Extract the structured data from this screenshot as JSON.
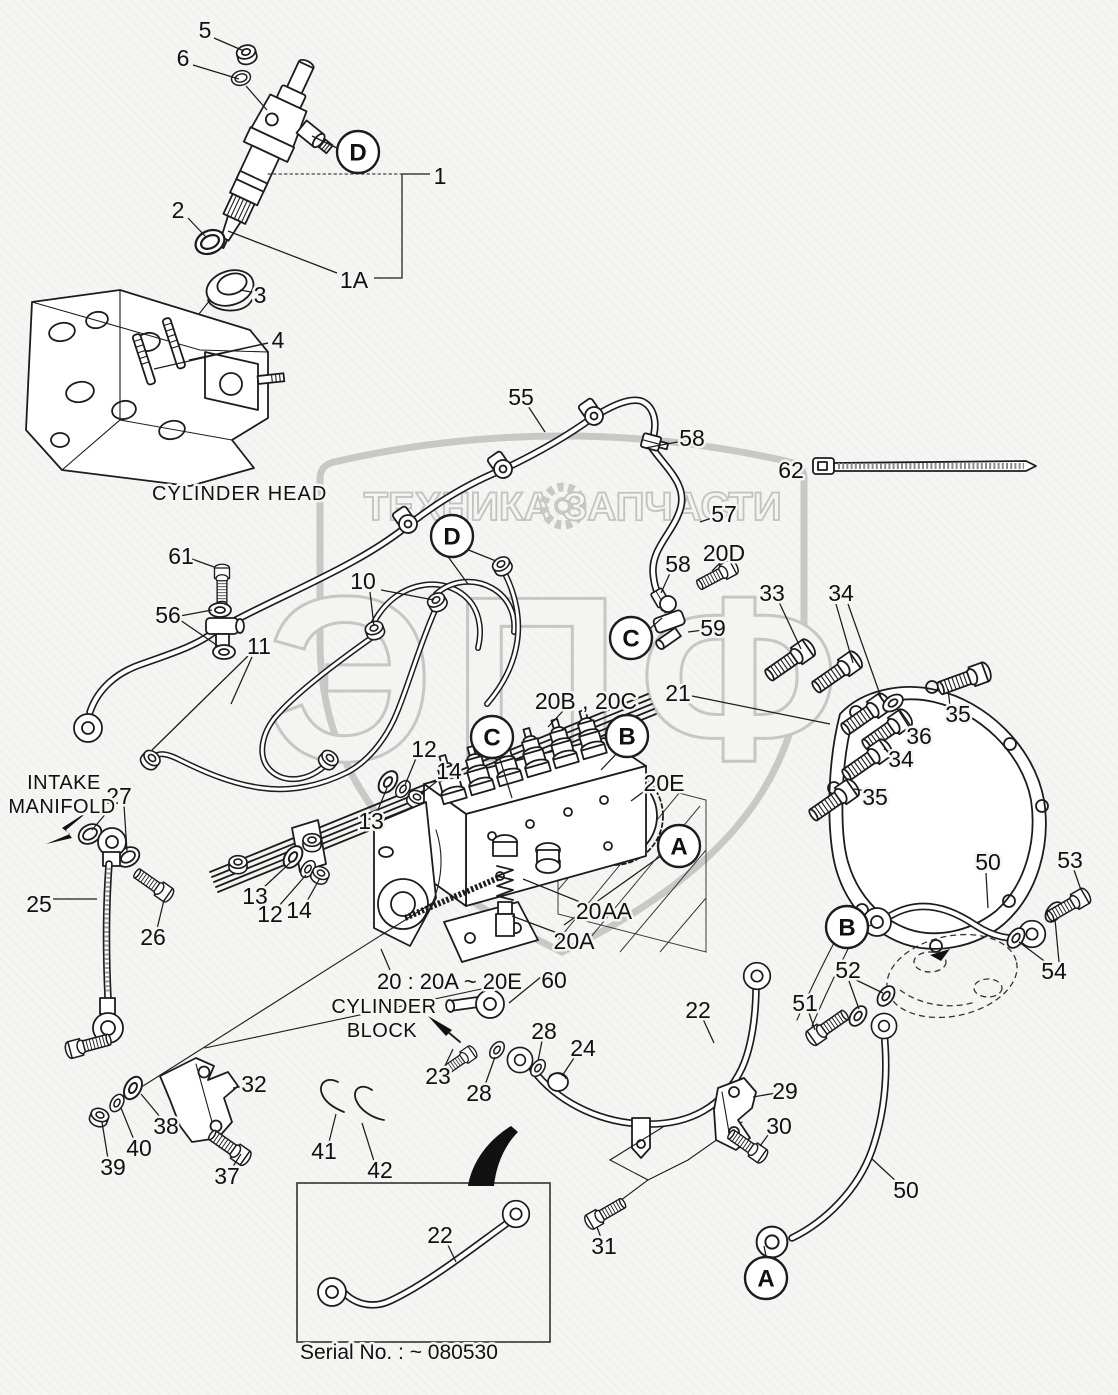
{
  "figure": {
    "colors": {
      "ink": "#1c1c1c",
      "background": "#f5f5f3",
      "watermark": "#c8c8c6"
    },
    "watermark": {
      "band_left": "ТЕХНИКА",
      "band_right": "ЗАПЧАСТИ",
      "monogram": "ЭПФ",
      "gear_icon": "gear-icon"
    },
    "texts": [
      {
        "id": "cylinder-head-label",
        "text": "CYLINDER HEAD",
        "x": 152,
        "y": 500,
        "size": 20,
        "anchor": "start",
        "spacing": 1
      },
      {
        "id": "intake-manifold-line1",
        "text": "INTAKE",
        "x": 64,
        "y": 789,
        "size": 20,
        "anchor": "middle",
        "spacing": 0.5
      },
      {
        "id": "intake-manifold-line2",
        "text": "MANIFOLD",
        "x": 62,
        "y": 813,
        "size": 20,
        "anchor": "middle",
        "spacing": 0.5
      },
      {
        "id": "cylinder-block-line1",
        "text": "CYLINDER",
        "x": 384,
        "y": 1013,
        "size": 20,
        "anchor": "middle",
        "spacing": 0.5
      },
      {
        "id": "cylinder-block-line2",
        "text": "BLOCK",
        "x": 382,
        "y": 1037,
        "size": 20,
        "anchor": "middle",
        "spacing": 0.5
      },
      {
        "id": "pump-group-note",
        "text": "20 : 20A ~ 20E",
        "x": 377,
        "y": 989,
        "size": 22,
        "anchor": "start",
        "spacing": 0
      },
      {
        "id": "serial-note",
        "text": "Serial No. : ~ 080530",
        "x": 300,
        "y": 1359,
        "size": 21,
        "anchor": "start",
        "spacing": 0
      }
    ],
    "callouts": [
      {
        "label": "5",
        "x": 205,
        "y": 30,
        "leaders": [
          [
            214,
            38,
            244,
            51
          ]
        ]
      },
      {
        "label": "6",
        "x": 183,
        "y": 58,
        "leaders": [
          [
            193,
            65,
            239,
            79
          ],
          [
            246,
            86,
            267,
            110
          ]
        ]
      },
      {
        "label": "1",
        "x": 440,
        "y": 176,
        "leaders": []
      },
      {
        "label": "1A",
        "x": 354,
        "y": 280,
        "leaders": [
          [
            337,
            273,
            228,
            231
          ]
        ]
      },
      {
        "label": "2",
        "x": 178,
        "y": 210,
        "leaders": [
          [
            188,
            218,
            206,
            237
          ]
        ]
      },
      {
        "label": "3",
        "x": 260,
        "y": 295,
        "leaders": [
          [
            251,
            292,
            240,
            290
          ]
        ]
      },
      {
        "label": "4",
        "x": 278,
        "y": 340,
        "leaders": [
          [
            268,
            343,
            154,
            369
          ],
          [
            268,
            343,
            189,
            360
          ]
        ]
      },
      {
        "label": "55",
        "x": 521,
        "y": 397,
        "leaders": [
          [
            528,
            406,
            545,
            432
          ]
        ]
      },
      {
        "label": "58",
        "x": 692,
        "y": 438,
        "leaders": [
          [
            683,
            441,
            645,
            448
          ]
        ]
      },
      {
        "label": "62",
        "x": 791,
        "y": 470,
        "leaders": []
      },
      {
        "label": "57",
        "x": 724,
        "y": 514,
        "leaders": [
          [
            715,
            517,
            700,
            522
          ]
        ]
      },
      {
        "label": "20D",
        "x": 724,
        "y": 553,
        "leaders": [
          [
            722,
            561,
            712,
            571
          ]
        ]
      },
      {
        "label": "58",
        "x": 678,
        "y": 564,
        "leaders": [
          [
            671,
            571,
            661,
            593
          ]
        ]
      },
      {
        "label": "59",
        "x": 713,
        "y": 628,
        "leaders": [
          [
            704,
            630,
            688,
            632
          ]
        ]
      },
      {
        "label": "61",
        "x": 181,
        "y": 556,
        "leaders": [
          [
            192,
            559,
            214,
            567
          ]
        ]
      },
      {
        "label": "56",
        "x": 168,
        "y": 615,
        "leaders": [
          [
            180,
            616,
            212,
            610
          ],
          [
            180,
            620,
            218,
            646
          ]
        ]
      },
      {
        "label": "10",
        "x": 363,
        "y": 581,
        "leaders": [
          [
            370,
            592,
            374,
            626
          ],
          [
            381,
            590,
            434,
            600
          ]
        ]
      },
      {
        "label": "11",
        "x": 259,
        "y": 646,
        "leaders": [
          [
            252,
            657,
            231,
            704
          ],
          [
            249,
            655,
            152,
            750
          ]
        ]
      },
      {
        "label": "12",
        "x": 424,
        "y": 749,
        "leaders": [
          [
            417,
            756,
            405,
            785
          ]
        ]
      },
      {
        "label": "14",
        "x": 449,
        "y": 771,
        "leaders": [
          [
            441,
            778,
            421,
            794
          ]
        ]
      },
      {
        "label": "13",
        "x": 371,
        "y": 821,
        "leaders": [
          [
            377,
            812,
            387,
            788
          ]
        ]
      },
      {
        "label": "20B , 20C",
        "x": 586,
        "y": 701,
        "leaders": [
          [
            563,
            711,
            548,
            727
          ]
        ]
      },
      {
        "label": "20E",
        "x": 664,
        "y": 783,
        "leaders": [
          [
            650,
            787,
            631,
            801
          ]
        ]
      },
      {
        "label": "21",
        "x": 678,
        "y": 693,
        "leaders": [
          [
            692,
            696,
            830,
            724
          ]
        ]
      },
      {
        "label": "33",
        "x": 772,
        "y": 593,
        "leaders": [
          [
            779,
            602,
            801,
            649
          ]
        ]
      },
      {
        "label": "34",
        "x": 841,
        "y": 593,
        "leaders": [
          [
            836,
            604,
            853,
            663
          ],
          [
            848,
            604,
            882,
            700
          ]
        ]
      },
      {
        "label": "35",
        "x": 958,
        "y": 714,
        "leaders": [
          [
            950,
            706,
            948,
            689
          ]
        ]
      },
      {
        "label": "36",
        "x": 919,
        "y": 736,
        "leaders": [
          [
            911,
            730,
            897,
            708
          ]
        ]
      },
      {
        "label": "34",
        "x": 901,
        "y": 759,
        "leaders": [
          [
            893,
            753,
            884,
            749
          ]
        ]
      },
      {
        "label": "35",
        "x": 875,
        "y": 797,
        "leaders": [
          [
            867,
            791,
            854,
            789
          ]
        ]
      },
      {
        "label": "27",
        "x": 119,
        "y": 796,
        "leaders": [
          [
            113,
            805,
            92,
            830
          ],
          [
            124,
            805,
            127,
            851
          ]
        ]
      },
      {
        "label": "25",
        "x": 39,
        "y": 904,
        "leaders": [
          [
            53,
            899,
            97,
            899
          ]
        ]
      },
      {
        "label": "26",
        "x": 153,
        "y": 937,
        "leaders": [
          [
            157,
            929,
            164,
            900
          ]
        ]
      },
      {
        "label": "13",
        "x": 255,
        "y": 896,
        "leaders": [
          [
            263,
            888,
            291,
            862
          ]
        ]
      },
      {
        "label": "12",
        "x": 270,
        "y": 914,
        "leaders": [
          [
            278,
            907,
            306,
            875
          ]
        ]
      },
      {
        "label": "14",
        "x": 299,
        "y": 910,
        "leaders": [
          [
            306,
            903,
            320,
            878
          ]
        ]
      },
      {
        "label": "20AA",
        "x": 604,
        "y": 911,
        "leaders": [
          [
            585,
            904,
            523,
            879
          ]
        ]
      },
      {
        "label": "20A",
        "x": 574,
        "y": 941,
        "leaders": [
          [
            560,
            934,
            512,
            916
          ]
        ]
      },
      {
        "label": "60",
        "x": 554,
        "y": 980,
        "leaders": [
          [
            547,
            972,
            509,
            1003
          ]
        ]
      },
      {
        "label": "23",
        "x": 438,
        "y": 1076,
        "leaders": [
          [
            444,
            1068,
            453,
            1049
          ]
        ]
      },
      {
        "label": "28",
        "x": 544,
        "y": 1031,
        "leaders": [
          [
            542,
            1041,
            538,
            1061
          ]
        ]
      },
      {
        "label": "28",
        "x": 479,
        "y": 1093,
        "leaders": [
          [
            485,
            1085,
            495,
            1057
          ]
        ]
      },
      {
        "label": "24",
        "x": 583,
        "y": 1048,
        "leaders": [
          [
            576,
            1055,
            562,
            1076
          ]
        ]
      },
      {
        "label": "22",
        "x": 698,
        "y": 1010,
        "leaders": [
          [
            703,
            1019,
            714,
            1043
          ]
        ]
      },
      {
        "label": "29",
        "x": 785,
        "y": 1091,
        "leaders": [
          [
            776,
            1093,
            753,
            1097
          ]
        ]
      },
      {
        "label": "30",
        "x": 779,
        "y": 1126,
        "leaders": [
          [
            771,
            1131,
            760,
            1146
          ]
        ]
      },
      {
        "label": "31",
        "x": 604,
        "y": 1246,
        "leaders": [
          [
            601,
            1238,
            597,
            1227
          ]
        ]
      },
      {
        "label": "32",
        "x": 254,
        "y": 1084,
        "leaders": [
          [
            246,
            1086,
            233,
            1088
          ]
        ]
      },
      {
        "label": "38",
        "x": 166,
        "y": 1126,
        "leaders": [
          [
            161,
            1118,
            141,
            1094
          ]
        ]
      },
      {
        "label": "40",
        "x": 139,
        "y": 1148,
        "leaders": [
          [
            134,
            1140,
            121,
            1108
          ]
        ]
      },
      {
        "label": "39",
        "x": 113,
        "y": 1167,
        "leaders": [
          [
            108,
            1159,
            102,
            1122
          ]
        ]
      },
      {
        "label": "37",
        "x": 227,
        "y": 1176,
        "leaders": [
          [
            232,
            1168,
            241,
            1154
          ]
        ]
      },
      {
        "label": "41",
        "x": 324,
        "y": 1151,
        "leaders": [
          [
            329,
            1142,
            336,
            1114
          ]
        ]
      },
      {
        "label": "42",
        "x": 380,
        "y": 1170,
        "leaders": [
          [
            374,
            1161,
            362,
            1123
          ]
        ]
      },
      {
        "label": "22",
        "x": 440,
        "y": 1235,
        "leaders": [
          [
            447,
            1243,
            456,
            1262
          ]
        ]
      },
      {
        "label": "50",
        "x": 988,
        "y": 862,
        "leaders": [
          [
            986,
            873,
            988,
            908
          ]
        ]
      },
      {
        "label": "53",
        "x": 1070,
        "y": 860,
        "leaders": [
          [
            1074,
            870,
            1081,
            890
          ]
        ]
      },
      {
        "label": "54",
        "x": 1054,
        "y": 971,
        "leaders": [
          [
            1047,
            963,
            1019,
            942
          ],
          [
            1059,
            962,
            1055,
            919
          ]
        ]
      },
      {
        "label": "52",
        "x": 848,
        "y": 970,
        "leaders": [
          [
            854,
            979,
            883,
            993
          ],
          [
            849,
            981,
            859,
            1009
          ]
        ]
      },
      {
        "label": "51",
        "x": 805,
        "y": 1003,
        "leaders": [
          [
            809,
            1013,
            815,
            1030
          ]
        ]
      },
      {
        "label": "50",
        "x": 906,
        "y": 1190,
        "leaders": [
          [
            898,
            1183,
            872,
            1159
          ]
        ]
      }
    ],
    "ref_circles": [
      {
        "letter": "D",
        "x": 358,
        "y": 152,
        "leaders": [
          [
            339,
            149,
            312,
            136
          ]
        ]
      },
      {
        "letter": "D",
        "x": 452,
        "y": 536,
        "leaders": [
          [
            461,
            547,
            496,
            561
          ],
          [
            446,
            554,
            468,
            584
          ]
        ]
      },
      {
        "letter": "C",
        "x": 631,
        "y": 638,
        "leaders": [
          [
            645,
            633,
            662,
            618
          ]
        ]
      },
      {
        "letter": "C",
        "x": 492,
        "y": 737,
        "leaders": [
          [
            498,
            753,
            512,
            798
          ]
        ]
      },
      {
        "letter": "B",
        "x": 627,
        "y": 736,
        "leaders": [
          [
            620,
            750,
            601,
            770
          ]
        ]
      },
      {
        "letter": "A",
        "x": 679,
        "y": 846,
        "leaders": [
          [
            665,
            853,
            564,
            925
          ]
        ]
      },
      {
        "letter": "B",
        "x": 847,
        "y": 927,
        "leaders": [
          [
            864,
            927,
            872,
            925
          ]
        ]
      },
      {
        "letter": "A",
        "x": 766,
        "y": 1278,
        "leaders": [
          [
            766,
            1256,
            764,
            1246
          ]
        ]
      }
    ]
  }
}
